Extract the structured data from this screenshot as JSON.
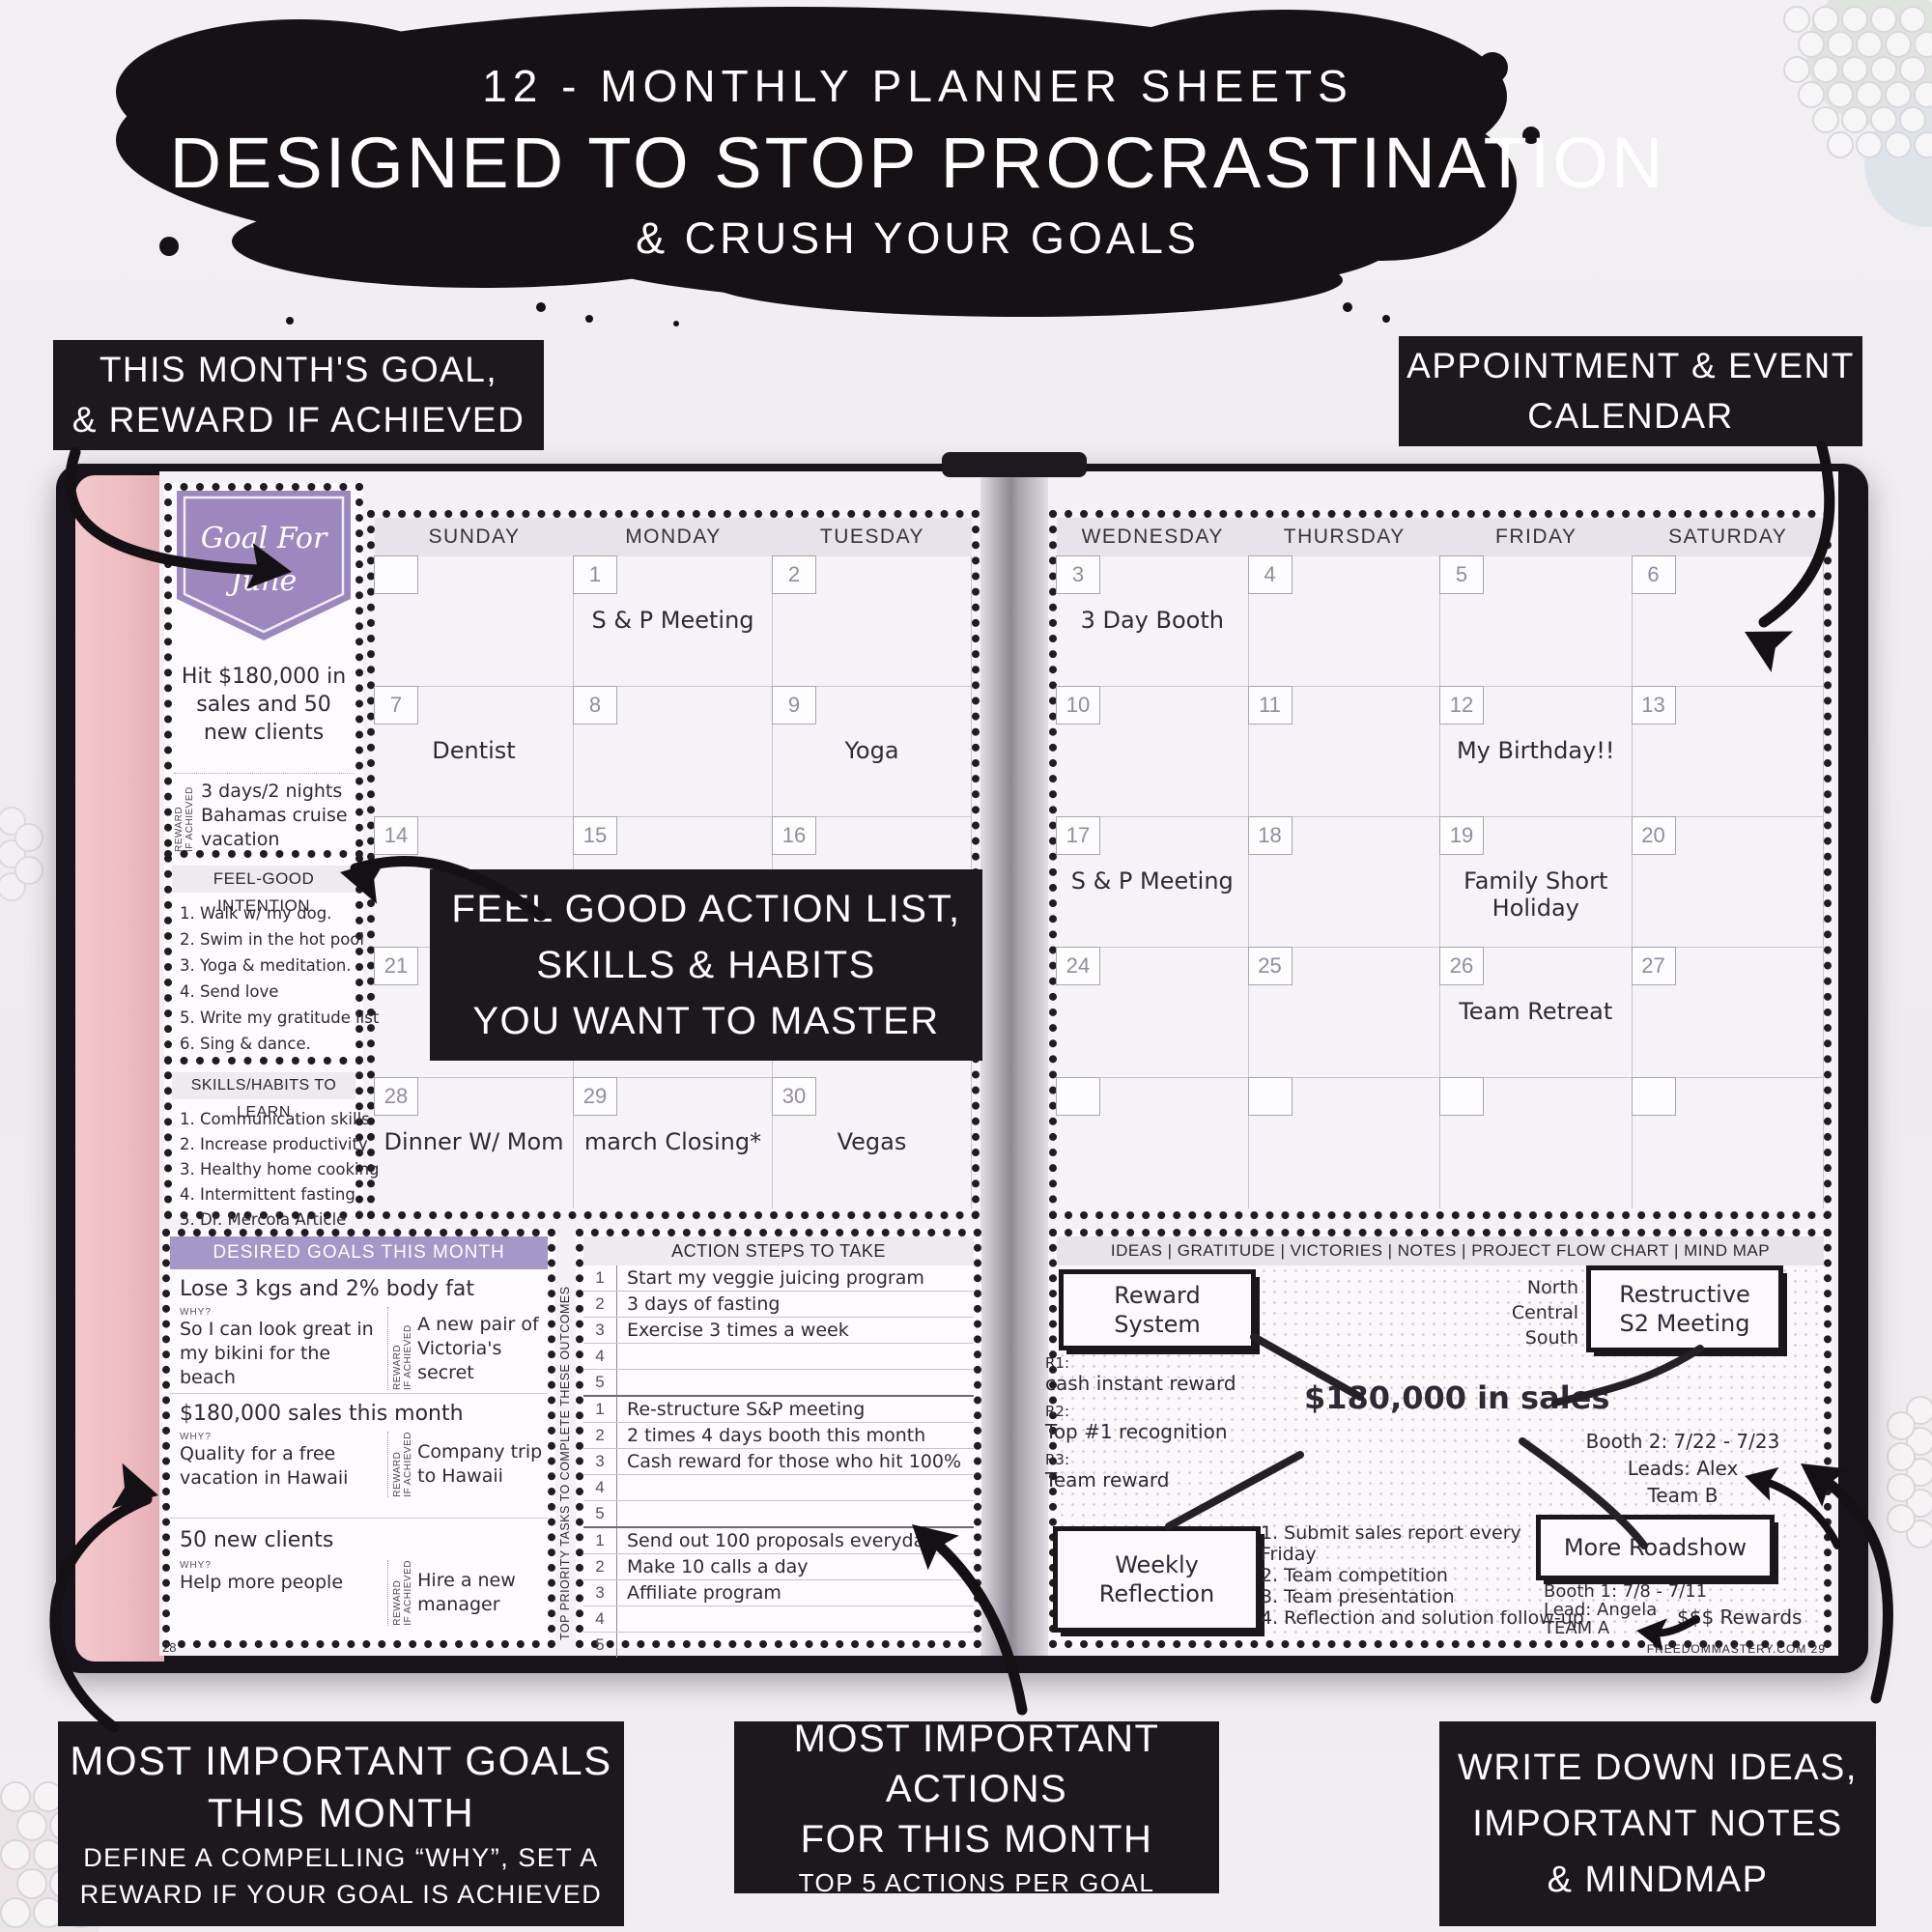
{
  "title": {
    "line1": "12 - MONTHLY PLANNER SHEETS",
    "line2": "DESIGNED TO STOP PROCRASTINATION",
    "line3": "& CRUSH YOUR GOALS"
  },
  "callouts": {
    "top_left_1": "THIS MONTH'S GOAL,",
    "top_left_2": "& REWARD IF ACHIEVED",
    "top_right_1": "APPOINTMENT & EVENT",
    "top_right_2": "CALENDAR",
    "center_1": "FEEL GOOD ACTION LIST,",
    "center_2": "SKILLS & HABITS",
    "center_3": "YOU WANT TO MASTER",
    "bottom_left_title_1": "MOST IMPORTANT GOALS",
    "bottom_left_title_2": "THIS MONTH",
    "bottom_left_sub_1": "DEFINE A COMPELLING “WHY”, SET A",
    "bottom_left_sub_2": "REWARD IF YOUR GOAL IS ACHIEVED",
    "bottom_center_title_1": "MOST IMPORTANT ACTIONS",
    "bottom_center_title_2": "FOR THIS MONTH",
    "bottom_center_sub": "TOP 5 ACTIONS PER GOAL",
    "bottom_right_1": "WRITE DOWN IDEAS,",
    "bottom_right_2": "IMPORTANT NOTES",
    "bottom_right_3": "& MINDMAP"
  },
  "goal_panel": {
    "banner_1": "Goal For",
    "banner_2": "June",
    "goal": "Hit $180,000 in sales and 50 new clients",
    "reward_label_1": "REWARD",
    "reward_label_2": "IF ACHIEVED",
    "reward": "3 days/2 nights Bahamas cruise vacation",
    "feel_good_title": "FEEL-GOOD INTENTION",
    "feel_good_items": [
      "1. Walk w/ my dog.",
      "2. Swim in the hot pool",
      "3. Yoga & meditation.",
      "4. Send love",
      "5. Write my gratitude list",
      "6. Sing & dance."
    ],
    "skills_title": "SKILLS/HABITS TO LEARN",
    "skills_items": [
      "1. Communication skills",
      "2. Increase productivity",
      "3. Healthy home cooking",
      "4. Intermittent fasting",
      "5. Dr. Mercola Article"
    ]
  },
  "calendar": {
    "left_days": [
      "SUNDAY",
      "MONDAY",
      "TUESDAY"
    ],
    "right_days": [
      "WEDNESDAY",
      "THURSDAY",
      "FRIDAY",
      "SATURDAY"
    ],
    "left_rows": [
      [
        {
          "num": "",
          "event": ""
        },
        {
          "num": "1",
          "event": "S & P Meeting"
        },
        {
          "num": "2",
          "event": ""
        }
      ],
      [
        {
          "num": "7",
          "event": "Dentist"
        },
        {
          "num": "8",
          "event": ""
        },
        {
          "num": "9",
          "event": "Yoga"
        }
      ],
      [
        {
          "num": "14",
          "event": ""
        },
        {
          "num": "15",
          "event": ""
        },
        {
          "num": "16",
          "event": ""
        }
      ],
      [
        {
          "num": "21",
          "event": ""
        },
        {
          "num": "",
          "event": ""
        },
        {
          "num": "",
          "event": ""
        }
      ],
      [
        {
          "num": "28",
          "event": "Dinner W/ Mom"
        },
        {
          "num": "29",
          "event": "march Closing*"
        },
        {
          "num": "30",
          "event": "Vegas"
        }
      ]
    ],
    "right_rows": [
      [
        {
          "num": "3",
          "event": "3 Day Booth"
        },
        {
          "num": "4",
          "event": ""
        },
        {
          "num": "5",
          "event": ""
        },
        {
          "num": "6",
          "event": ""
        }
      ],
      [
        {
          "num": "10",
          "event": ""
        },
        {
          "num": "11",
          "event": ""
        },
        {
          "num": "12",
          "event": "My Birthday!!"
        },
        {
          "num": "13",
          "event": ""
        }
      ],
      [
        {
          "num": "17",
          "event": "S & P Meeting"
        },
        {
          "num": "18",
          "event": ""
        },
        {
          "num": "19",
          "event": "Family Short Holiday"
        },
        {
          "num": "20",
          "event": ""
        }
      ],
      [
        {
          "num": "24",
          "event": ""
        },
        {
          "num": "25",
          "event": ""
        },
        {
          "num": "26",
          "event": "Team Retreat"
        },
        {
          "num": "27",
          "event": ""
        }
      ],
      [
        {
          "num": "",
          "event": ""
        },
        {
          "num": "",
          "event": ""
        },
        {
          "num": "",
          "event": ""
        },
        {
          "num": "",
          "event": ""
        }
      ]
    ]
  },
  "goals_section": {
    "header": "DESIRED GOALS THIS MONTH",
    "why_label": "WHY?",
    "reward_label_1": "REWARD",
    "reward_label_2": "IF ACHIEVED",
    "side_label": "TOP PRIORITY TASKS TO COMPLETE THESE OUTCOMES",
    "goals": [
      {
        "goal": "Lose 3 kgs and 2% body fat",
        "why": "So I can look great in my bikini for the beach",
        "reward": "A new pair of Victoria's secret"
      },
      {
        "goal": "$180,000 sales this month",
        "why": "Quality for a free vacation in Hawaii",
        "reward": "Company trip to Hawaii"
      },
      {
        "goal": "50 new clients",
        "why": "Help more people",
        "reward": "Hire a new manager"
      }
    ]
  },
  "action_steps": {
    "header": "ACTION STEPS TO TAKE",
    "numbers": [
      "1",
      "2",
      "3",
      "4",
      "5"
    ],
    "groups": [
      [
        "Start my veggie juicing program",
        "3 days of fasting",
        "Exercise 3 times a week",
        "",
        ""
      ],
      [
        "Re-structure S&P meeting",
        "2 times 4 days booth this month",
        "Cash reward for those who hit 100%",
        "",
        ""
      ],
      [
        "Send out 100 proposals everyday",
        "Make 10 calls a day",
        "Affiliate program",
        "",
        ""
      ]
    ]
  },
  "mindmap": {
    "header": "IDEAS | GRATITUDE | VICTORIES | NOTES | PROJECT FLOW CHART | MIND MAP",
    "reward_system": "Reward System",
    "region_1": "North",
    "region_2": "Central",
    "region_3": "South",
    "restructive": "Restructive S2 Meeting",
    "r1_label": "R1:",
    "r1": "cash instant reward",
    "r2_label": "R2:",
    "r2": "Top #1 recognition",
    "r3_label": "R3:",
    "r3": "Team reward",
    "center": "$180,000 in sales",
    "booth2_1": "Booth 2: 7/22 - 7/23",
    "booth2_2": "Leads: Alex",
    "booth2_3": "Team B",
    "weekly_reflection": "Weekly Reflection",
    "weekly_items": [
      "1. Submit sales report every Friday",
      "2. Team competition",
      "3. Team presentation",
      "4. Reflection and solution follow-up"
    ],
    "more_roadshow": "More Roadshow",
    "booth1_1": "Booth 1: 7/8 - 7/11",
    "booth1_2": "Lead: Angela",
    "booth1_3": "TEAM A",
    "rewards_note": "$$$ Rewards"
  },
  "footer": {
    "left_page_number": "28",
    "right_footer": "FREEDOMMASTERY.COM  29"
  },
  "colors": {
    "accent_purple": "#9d87bf",
    "header_purple": "#a697c9",
    "ink_black": "#1c181d"
  }
}
